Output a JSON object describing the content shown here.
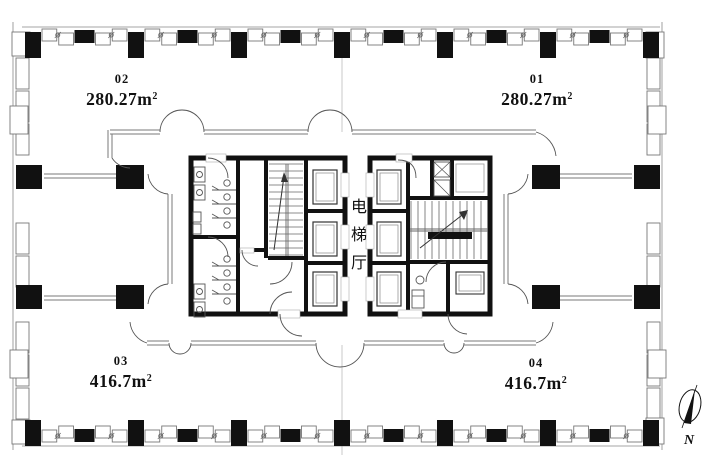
{
  "units": {
    "u01": {
      "number": "01",
      "area_main": "280.27m",
      "area_exp": "2"
    },
    "u02": {
      "number": "02",
      "area_main": "280.27m",
      "area_exp": "2"
    },
    "u03": {
      "number": "03",
      "area_main": "416.7m",
      "area_exp": "2"
    },
    "u04": {
      "number": "04",
      "area_main": "416.7m",
      "area_exp": "2"
    }
  },
  "core": {
    "label": "电梯厅"
  },
  "north": {
    "label": "N"
  },
  "colors": {
    "wall": "#111111",
    "line": "#7a7a7a",
    "thin": "#999999",
    "detail": "#555555"
  }
}
